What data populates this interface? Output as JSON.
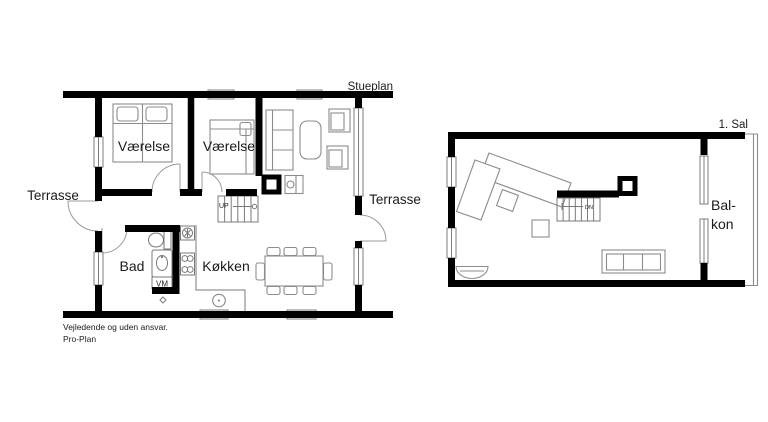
{
  "colors": {
    "background": "#ffffff",
    "wall": "#000000",
    "furniture_line": "#8c8c8c",
    "text": "#1b1b1b"
  },
  "ground_floor": {
    "title": "Stueplan",
    "room_labels": {
      "bedroom1": "Værelse",
      "bedroom2": "Værelse",
      "bathroom": "Bad",
      "kitchen": "Køkken"
    },
    "exterior_labels": {
      "terrace_left": "Terrasse",
      "terrace_right": "Terrasse"
    },
    "annotations": {
      "stairs_direction": "UP",
      "washing_machine": "VM"
    }
  },
  "first_floor": {
    "title": "1. Sal",
    "room_labels": {
      "balcony_line1": "Bal-",
      "balcony_line2": "kon"
    },
    "annotations": {
      "stairs_direction": "DN"
    }
  },
  "disclaimer": {
    "line1": "Vejledende og uden ansvar.",
    "line2": "Pro-Plan"
  }
}
